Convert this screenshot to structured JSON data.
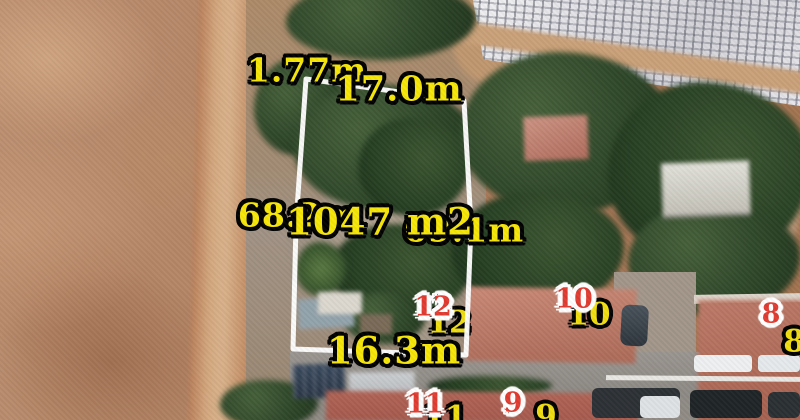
{
  "map": {
    "dimensions": {
      "top_offset": "1.77m",
      "top_width": "17.0m",
      "left_length": "68.2m",
      "area": "1047 m2",
      "right_length": "69.1m",
      "bottom_width": "16.3m"
    },
    "house_numbers": [
      "12",
      "10",
      "8",
      "11",
      "9"
    ],
    "colors": {
      "dimension_label": "#f7e608",
      "label_outline": "#000000",
      "house_number_red": "#e03b2f",
      "house_number_halo": "#ffffff",
      "house_number_yellow": "#f0dd12",
      "parcel_boundary": "#ffffff"
    }
  }
}
